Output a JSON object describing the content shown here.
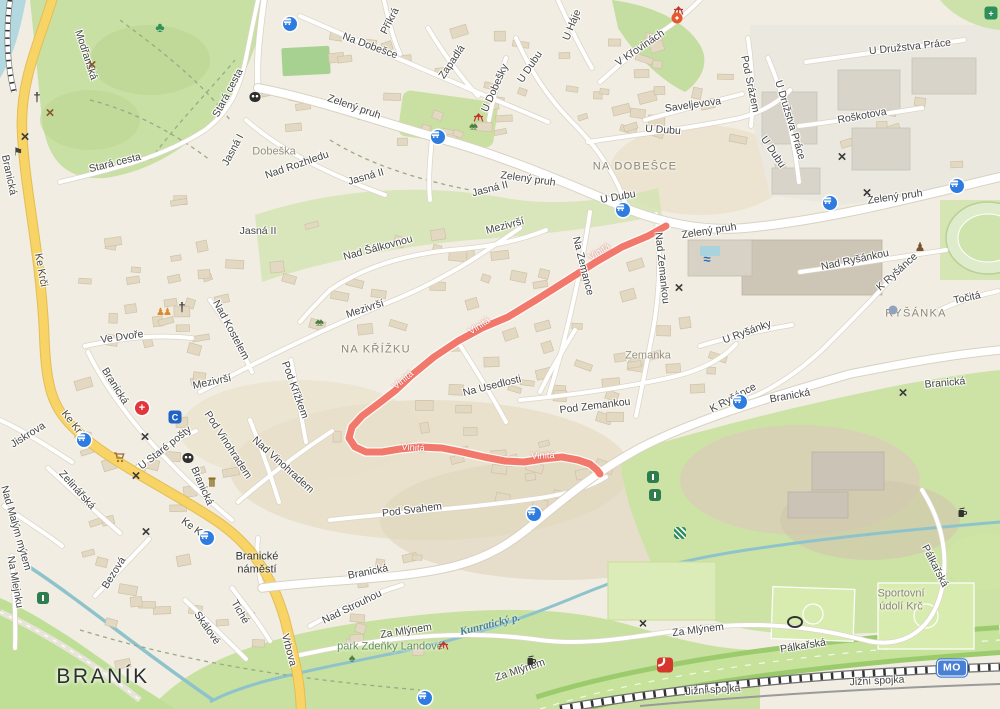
{
  "map": {
    "colors": {
      "land": "#f1ede2",
      "park": "#cde2a6",
      "water": "#aed6de",
      "road_yellow": "#f7d465",
      "road_white": "#ffffff",
      "route": "#f3786c",
      "transit_blue": "#2e7ce0"
    },
    "route": {
      "name": "Vinitá",
      "color": "#f3786c",
      "points": [
        [
          666,
          226
        ],
        [
          648,
          236
        ],
        [
          622,
          247
        ],
        [
          596,
          262
        ],
        [
          566,
          281
        ],
        [
          536,
          300
        ],
        [
          508,
          317
        ],
        [
          482,
          328
        ],
        [
          458,
          341
        ],
        [
          434,
          357
        ],
        [
          412,
          375
        ],
        [
          396,
          390
        ],
        [
          378,
          404
        ],
        [
          362,
          416
        ],
        [
          352,
          427
        ],
        [
          349,
          438
        ],
        [
          355,
          447
        ],
        [
          366,
          452
        ],
        [
          382,
          452
        ],
        [
          400,
          449
        ],
        [
          420,
          447
        ],
        [
          442,
          448
        ],
        [
          462,
          452
        ],
        [
          484,
          457
        ],
        [
          505,
          461
        ],
        [
          524,
          462
        ],
        [
          543,
          459
        ],
        [
          562,
          457
        ],
        [
          578,
          460
        ],
        [
          590,
          464
        ],
        [
          597,
          470
        ],
        [
          600,
          474
        ]
      ]
    },
    "badges": [
      {
        "label": "MO",
        "x": 952,
        "y": 668
      }
    ],
    "labels": [
      {
        "t": "Modřanská",
        "x": 86,
        "y": 55,
        "r": 72,
        "c": "st"
      },
      {
        "t": "Branická",
        "x": 9,
        "y": 175,
        "r": 78,
        "c": "st"
      },
      {
        "t": "Stará cesta",
        "x": 228,
        "y": 93,
        "r": -62,
        "c": "st"
      },
      {
        "t": "Stará cesta",
        "x": 115,
        "y": 163,
        "r": -14,
        "c": "st"
      },
      {
        "t": "Jasná I",
        "x": 233,
        "y": 150,
        "r": -62,
        "c": "st"
      },
      {
        "t": "Dobeška",
        "x": 274,
        "y": 152,
        "r": 0,
        "c": "ar"
      },
      {
        "t": "Jasná II",
        "x": 258,
        "y": 231,
        "r": 0,
        "c": "st"
      },
      {
        "t": "Jasná II",
        "x": 366,
        "y": 177,
        "r": -16,
        "c": "st"
      },
      {
        "t": "Jasná II",
        "x": 490,
        "y": 189,
        "r": -14,
        "c": "st"
      },
      {
        "t": "Na Dobešce",
        "x": 370,
        "y": 46,
        "r": 20,
        "c": "st"
      },
      {
        "t": "Příkrá",
        "x": 390,
        "y": 21,
        "r": -63,
        "c": "st"
      },
      {
        "t": "Zapadlá",
        "x": 452,
        "y": 62,
        "r": -56,
        "c": "st"
      },
      {
        "t": "U Dobešky",
        "x": 495,
        "y": 88,
        "r": -66,
        "c": "st"
      },
      {
        "t": "U Háje",
        "x": 572,
        "y": 25,
        "r": -68,
        "c": "st"
      },
      {
        "t": "U Dubu",
        "x": 530,
        "y": 67,
        "r": -56,
        "c": "st"
      },
      {
        "t": "U Dubu",
        "x": 663,
        "y": 130,
        "r": 4,
        "c": "st"
      },
      {
        "t": "V Křovinách",
        "x": 640,
        "y": 48,
        "r": -34,
        "c": "st"
      },
      {
        "t": "Saveljevova",
        "x": 693,
        "y": 105,
        "r": -8,
        "c": "st"
      },
      {
        "t": "Pod Srázem",
        "x": 750,
        "y": 84,
        "r": 78,
        "c": "st"
      },
      {
        "t": "U Družstva Práce",
        "x": 910,
        "y": 47,
        "r": -6,
        "c": "st"
      },
      {
        "t": "U Družstva Práce",
        "x": 790,
        "y": 120,
        "r": 73,
        "c": "st"
      },
      {
        "t": "Roškotova",
        "x": 862,
        "y": 116,
        "r": -10,
        "c": "st"
      },
      {
        "t": "U Dubu",
        "x": 773,
        "y": 152,
        "r": 56,
        "c": "st"
      },
      {
        "t": "Zelený pruh",
        "x": 354,
        "y": 107,
        "r": 19,
        "c": "st"
      },
      {
        "t": "Zelený pruh",
        "x": 528,
        "y": 179,
        "r": 8,
        "c": "st"
      },
      {
        "t": "U Dubu",
        "x": 618,
        "y": 197,
        "r": -10,
        "c": "st"
      },
      {
        "t": "Zelený pruh",
        "x": 709,
        "y": 231,
        "r": -9,
        "c": "st"
      },
      {
        "t": "Zelený pruh",
        "x": 895,
        "y": 197,
        "r": -8,
        "c": "st"
      },
      {
        "t": "Nad Rozhledu",
        "x": 297,
        "y": 165,
        "r": -19,
        "c": "st"
      },
      {
        "t": "Nad Šálkovnou",
        "x": 378,
        "y": 248,
        "r": -15,
        "c": "st"
      },
      {
        "t": "Mezivrší",
        "x": 365,
        "y": 309,
        "r": -18,
        "c": "st"
      },
      {
        "t": "Mezivrší",
        "x": 505,
        "y": 226,
        "r": -15,
        "c": "st"
      },
      {
        "t": "Mezivrší",
        "x": 212,
        "y": 382,
        "r": -12,
        "c": "st"
      },
      {
        "t": "Na Zemance",
        "x": 583,
        "y": 266,
        "r": 76,
        "c": "st"
      },
      {
        "t": "Nad Zemankou",
        "x": 662,
        "y": 268,
        "r": 84,
        "c": "st"
      },
      {
        "t": "Nad Ryšánkou",
        "x": 855,
        "y": 260,
        "r": -12,
        "c": "st"
      },
      {
        "t": "K Ryšánce",
        "x": 897,
        "y": 272,
        "r": -42,
        "c": "st"
      },
      {
        "t": "K Ryšánce",
        "x": 733,
        "y": 398,
        "r": -28,
        "c": "st"
      },
      {
        "t": "Točitá",
        "x": 967,
        "y": 298,
        "r": -12,
        "c": "st"
      },
      {
        "t": "U Ryšánky",
        "x": 747,
        "y": 332,
        "r": -20,
        "c": "st"
      },
      {
        "t": "Ve Dvoře",
        "x": 122,
        "y": 337,
        "r": -8,
        "c": "st"
      },
      {
        "t": "Nad Kostelem",
        "x": 231,
        "y": 330,
        "r": 62,
        "c": "st"
      },
      {
        "t": "Pod Křížkem",
        "x": 295,
        "y": 390,
        "r": 70,
        "c": "st"
      },
      {
        "t": "Nad Vinohradem",
        "x": 283,
        "y": 465,
        "r": 42,
        "c": "st"
      },
      {
        "t": "Pod Vinohradem",
        "x": 228,
        "y": 445,
        "r": 57,
        "c": "st"
      },
      {
        "t": "Branická",
        "x": 115,
        "y": 386,
        "r": 58,
        "c": "st"
      },
      {
        "t": "Branická",
        "x": 202,
        "y": 486,
        "r": 66,
        "c": "st"
      },
      {
        "t": "U Staré pošty",
        "x": 165,
        "y": 448,
        "r": -38,
        "c": "st"
      },
      {
        "t": "Ke Krči",
        "x": 41,
        "y": 270,
        "r": 80,
        "c": "st"
      },
      {
        "t": "Ke Krči",
        "x": 74,
        "y": 425,
        "r": 52,
        "c": "st"
      },
      {
        "t": "Ke Krči",
        "x": 196,
        "y": 530,
        "r": 36,
        "c": "st"
      },
      {
        "t": "Jiskrova",
        "x": 28,
        "y": 435,
        "r": -32,
        "c": "st"
      },
      {
        "t": "Zelinářská",
        "x": 77,
        "y": 490,
        "r": 48,
        "c": "st"
      },
      {
        "t": "Nad Malým mýtem",
        "x": 16,
        "y": 528,
        "r": 74,
        "c": "st"
      },
      {
        "t": "Na Mlejnku",
        "x": 15,
        "y": 582,
        "r": 80,
        "c": "st"
      },
      {
        "t": "Bezová",
        "x": 114,
        "y": 573,
        "r": -58,
        "c": "st"
      },
      {
        "t": "Skálové",
        "x": 207,
        "y": 628,
        "r": 55,
        "c": "st"
      },
      {
        "t": "Tiché",
        "x": 240,
        "y": 612,
        "r": 60,
        "c": "st"
      },
      {
        "t": "Vrbova",
        "x": 289,
        "y": 650,
        "r": 75,
        "c": "st"
      },
      {
        "t": "Branická",
        "x": 368,
        "y": 572,
        "r": -11,
        "c": "st"
      },
      {
        "t": "Nad Strouhou",
        "x": 352,
        "y": 607,
        "r": -26,
        "c": "st"
      },
      {
        "t": "Za Mlýnem",
        "x": 406,
        "y": 631,
        "r": -9,
        "c": "st"
      },
      {
        "t": "Za Mlýnem",
        "x": 520,
        "y": 670,
        "r": -18,
        "c": "st"
      },
      {
        "t": "Za Mlýnem",
        "x": 698,
        "y": 630,
        "r": -7,
        "c": "st"
      },
      {
        "t": "Pod Zemankou",
        "x": 595,
        "y": 406,
        "r": -7,
        "c": "st"
      },
      {
        "t": "Na Usedlosti",
        "x": 492,
        "y": 386,
        "r": -14,
        "c": "st"
      },
      {
        "t": "Pod Svahem",
        "x": 412,
        "y": 510,
        "r": -7,
        "c": "st"
      },
      {
        "t": "Branická",
        "x": 790,
        "y": 396,
        "r": -10,
        "c": "st"
      },
      {
        "t": "Branická",
        "x": 945,
        "y": 383,
        "r": -5,
        "c": "st"
      },
      {
        "t": "Jižní spojka",
        "x": 713,
        "y": 690,
        "r": -4,
        "c": "st"
      },
      {
        "t": "Jižní spojka",
        "x": 877,
        "y": 681,
        "r": -3,
        "c": "st"
      },
      {
        "t": "Pálkařská",
        "x": 803,
        "y": 646,
        "r": -9,
        "c": "st"
      },
      {
        "t": "Pálkařská",
        "x": 935,
        "y": 566,
        "r": 63,
        "c": "st"
      },
      {
        "t": "NA DOBEŠCE",
        "x": 635,
        "y": 167,
        "r": 0,
        "c": "di"
      },
      {
        "t": "NA KŘÍŽKU",
        "x": 376,
        "y": 350,
        "r": 0,
        "c": "di"
      },
      {
        "t": "RYŠÁNKA",
        "x": 916,
        "y": 314,
        "r": 0,
        "c": "di"
      },
      {
        "t": "Zemanka",
        "x": 648,
        "y": 356,
        "r": 0,
        "c": "ar"
      },
      {
        "t": "BRANÍK",
        "x": 103,
        "y": 677,
        "r": 0,
        "c": "ci"
      },
      {
        "t": "Branické\nnáměstí",
        "x": 257,
        "y": 563,
        "r": 0,
        "c": "pl"
      },
      {
        "t": "park Zdeňky Landové",
        "x": 390,
        "y": 647,
        "r": 0,
        "c": "pk"
      },
      {
        "t": "Kunratický p.",
        "x": 490,
        "y": 625,
        "r": -14,
        "c": "wa"
      },
      {
        "t": "Sportovní\núdolí Krč",
        "x": 901,
        "y": 600,
        "r": 0,
        "c": "te"
      },
      {
        "t": "Vinitá",
        "x": 600,
        "y": 253,
        "r": -33,
        "c": "rt"
      },
      {
        "t": "Vinitá",
        "x": 480,
        "y": 327,
        "r": -33,
        "c": "rt"
      },
      {
        "t": "Vinitá",
        "x": 404,
        "y": 381,
        "r": -40,
        "c": "rt"
      },
      {
        "t": "Vinitá",
        "x": 413,
        "y": 449,
        "r": 4,
        "c": "rt"
      },
      {
        "t": "Vinitá",
        "x": 543,
        "y": 457,
        "r": -2,
        "c": "rt"
      }
    ],
    "icons": [
      {
        "k": "clover",
        "x": 160,
        "y": 27
      },
      {
        "k": "xbrown",
        "x": 92,
        "y": 65
      },
      {
        "k": "church",
        "x": 37,
        "y": 97
      },
      {
        "k": "xbrown",
        "x": 50,
        "y": 113
      },
      {
        "k": "xdark",
        "x": 25,
        "y": 137
      },
      {
        "k": "flag",
        "x": 18,
        "y": 153
      },
      {
        "k": "masks",
        "x": 255,
        "y": 97
      },
      {
        "k": "bus",
        "x": 290,
        "y": 24
      },
      {
        "k": "picnic",
        "x": 672,
        "y": 5
      },
      {
        "k": "carousel",
        "x": 677,
        "y": 18
      },
      {
        "k": "greencross",
        "x": 991,
        "y": 13
      },
      {
        "k": "picnic",
        "x": 472,
        "y": 112
      },
      {
        "k": "trees",
        "x": 472,
        "y": 127
      },
      {
        "k": "bus",
        "x": 438,
        "y": 137
      },
      {
        "k": "bus",
        "x": 623,
        "y": 210
      },
      {
        "k": "bus",
        "x": 830,
        "y": 203
      },
      {
        "k": "bus",
        "x": 957,
        "y": 186
      },
      {
        "k": "xdark",
        "x": 867,
        "y": 193
      },
      {
        "k": "xdark",
        "x": 842,
        "y": 157
      },
      {
        "k": "statue",
        "x": 920,
        "y": 247
      },
      {
        "k": "swim",
        "x": 707,
        "y": 259
      },
      {
        "k": "xdark",
        "x": 679,
        "y": 288
      },
      {
        "k": "dot",
        "x": 893,
        "y": 310
      },
      {
        "k": "trees",
        "x": 318,
        "y": 323
      },
      {
        "k": "church",
        "x": 182,
        "y": 307
      },
      {
        "k": "people",
        "x": 163,
        "y": 313
      },
      {
        "k": "hospital",
        "x": 142,
        "y": 408
      },
      {
        "k": "bankc",
        "x": 175,
        "y": 417
      },
      {
        "k": "xdark",
        "x": 145,
        "y": 437
      },
      {
        "k": "cart",
        "x": 113,
        "y": 452
      },
      {
        "k": "masks",
        "x": 188,
        "y": 458
      },
      {
        "k": "museum",
        "x": 212,
        "y": 483
      },
      {
        "k": "xdark",
        "x": 136,
        "y": 476
      },
      {
        "k": "xdark",
        "x": 146,
        "y": 532
      },
      {
        "k": "tram",
        "x": 84,
        "y": 440
      },
      {
        "k": "bus",
        "x": 207,
        "y": 538
      },
      {
        "k": "xdark",
        "x": 903,
        "y": 393
      },
      {
        "k": "bus",
        "x": 740,
        "y": 402
      },
      {
        "k": "bus",
        "x": 534,
        "y": 514
      },
      {
        "k": "greenhouse",
        "x": 653,
        "y": 477
      },
      {
        "k": "greenhouse",
        "x": 655,
        "y": 495
      },
      {
        "k": "recycle",
        "x": 680,
        "y": 533
      },
      {
        "k": "drink",
        "x": 957,
        "y": 507
      },
      {
        "k": "greenhouse",
        "x": 43,
        "y": 598
      },
      {
        "k": "tree",
        "x": 352,
        "y": 658
      },
      {
        "k": "picnic",
        "x": 437,
        "y": 640
      },
      {
        "k": "drink",
        "x": 526,
        "y": 655
      },
      {
        "k": "windmill",
        "x": 643,
        "y": 623
      },
      {
        "k": "fuel",
        "x": 665,
        "y": 665
      },
      {
        "k": "stadium",
        "x": 795,
        "y": 622
      },
      {
        "k": "bus",
        "x": 425,
        "y": 698
      }
    ]
  }
}
